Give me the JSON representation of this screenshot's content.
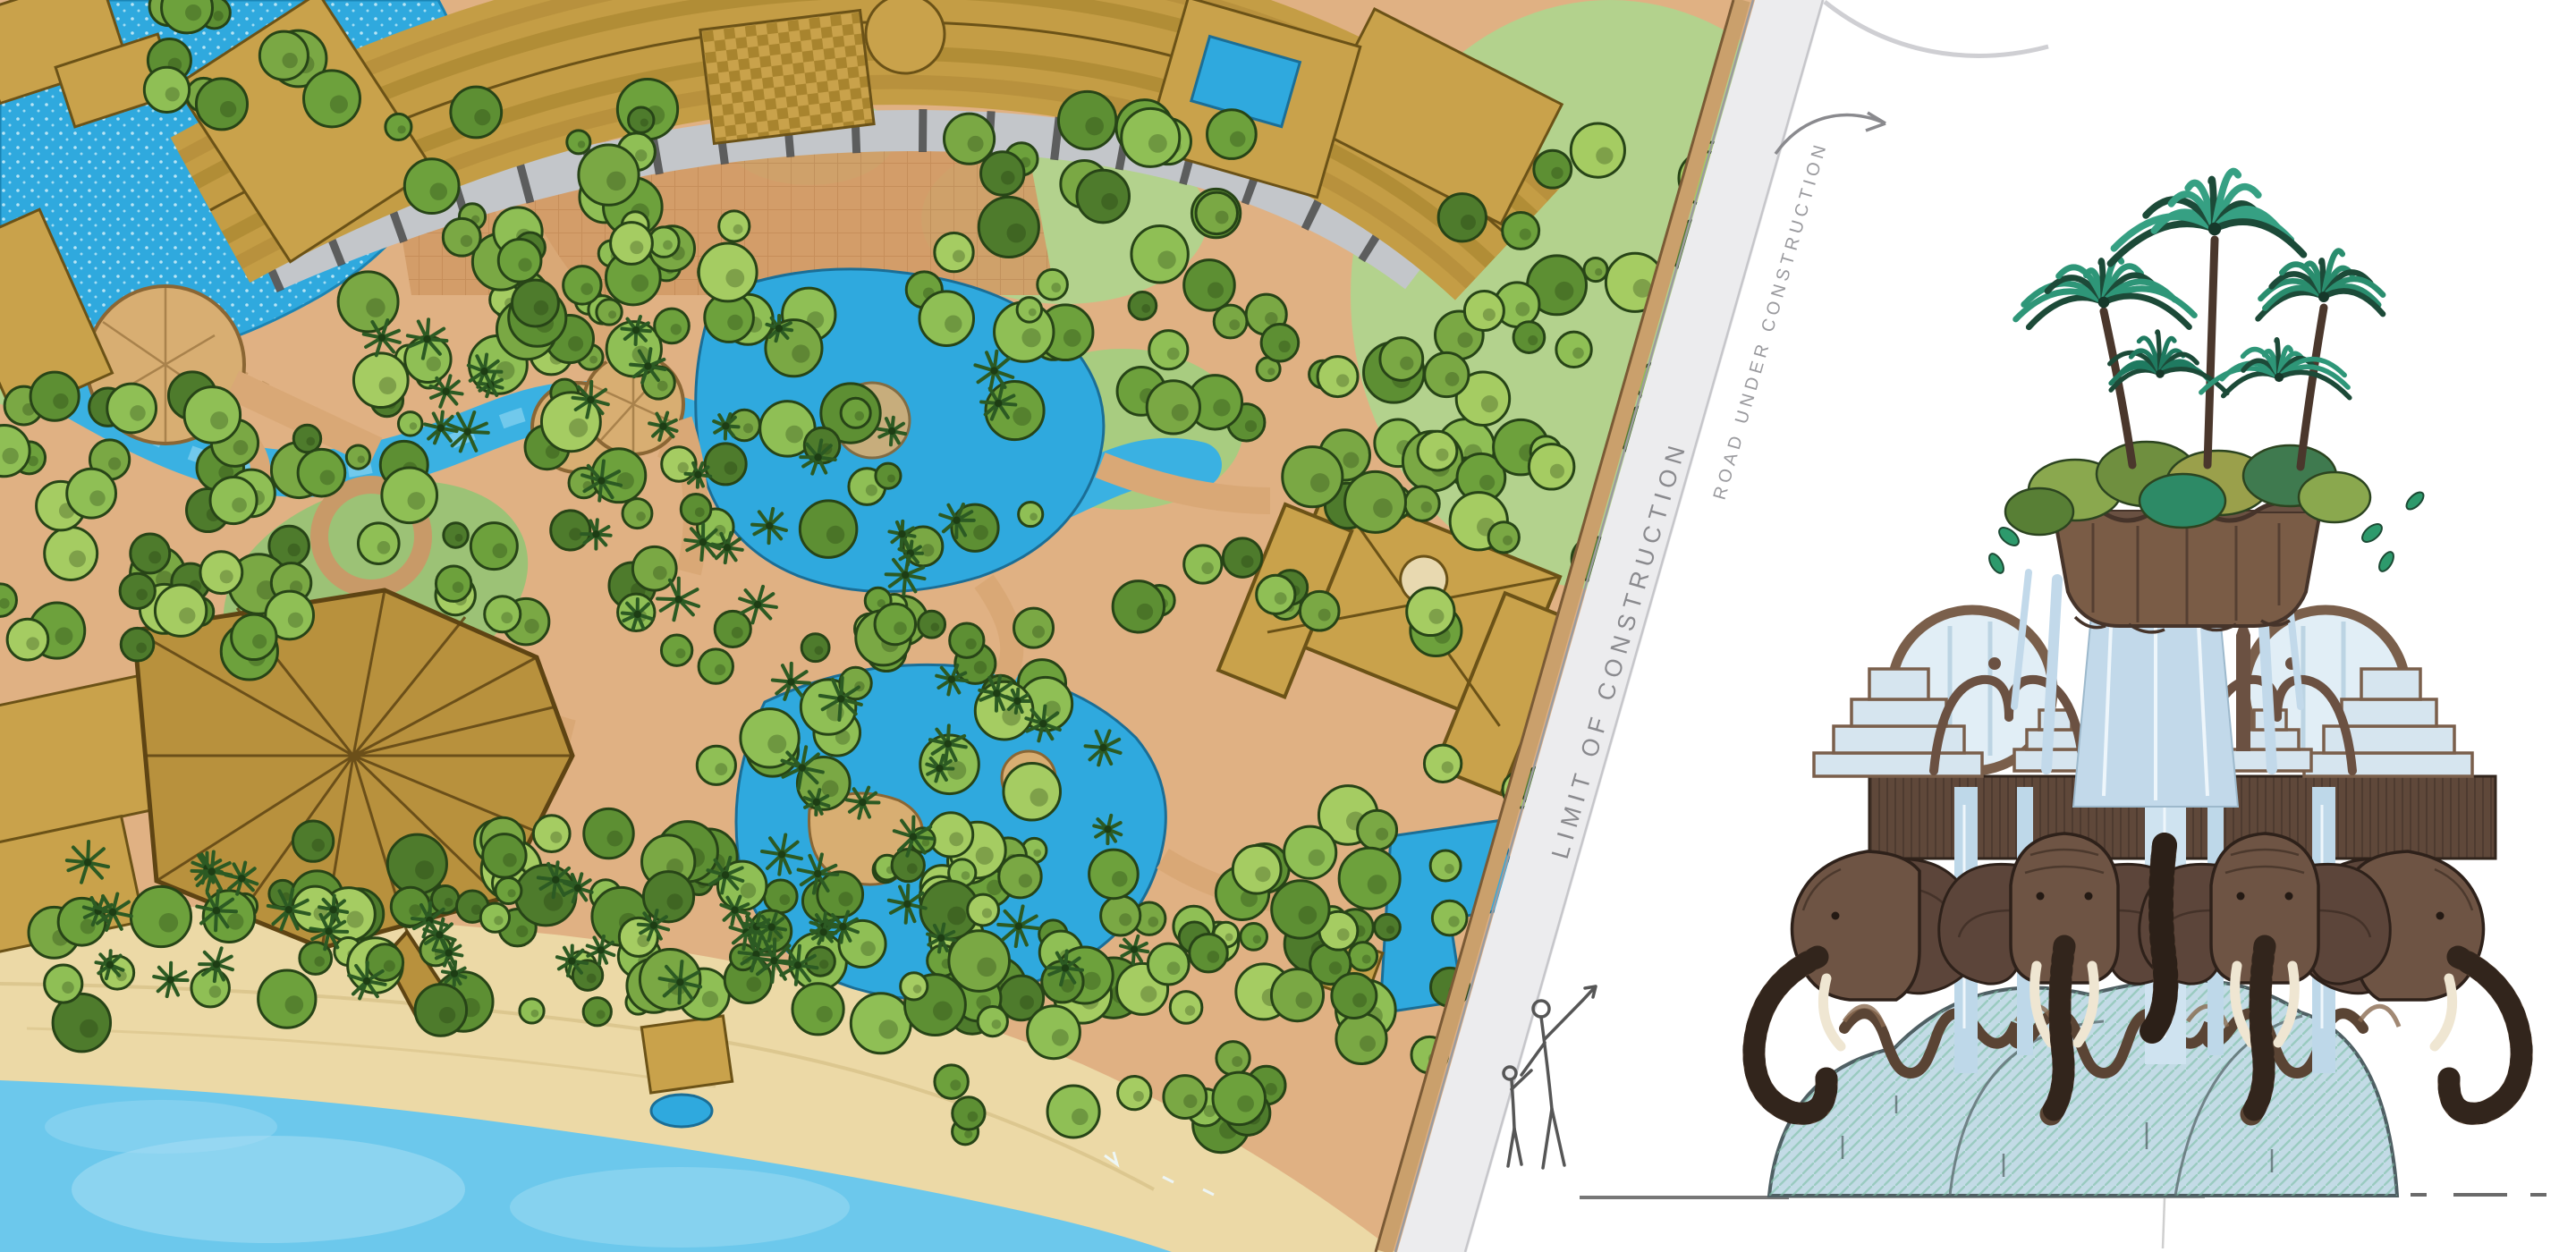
{
  "page": {
    "background": "#ffffff",
    "description": "Tropical resort water-park master plan beside a hand-drawn elephant waterfall fountain elevation sketch"
  },
  "site_plan": {
    "labels": {
      "limit_of_construction": "LIMIT OF CONSTRUCTION",
      "road_under_construction": "ROAD UNDER CONSTRUCTION"
    },
    "features": [
      "curved hotel wings with ribbed tan roofs",
      "wave pool with speckled water",
      "lazy river",
      "free-form lagoon pools",
      "island decks and round plazas",
      "angular lodge roof",
      "villa with courtyard pool",
      "beach",
      "ocean",
      "palm and shade tree canopy",
      "lawns",
      "construction road corridor"
    ],
    "colors": {
      "pool_blue": "#2fa9de",
      "river_blue": "#3ab1e2",
      "ocean_blue": "#6cc8ec",
      "sand": "#ecd9a6",
      "deck_terracotta": "#d29b66",
      "path_tan": "#d9a876",
      "roof_tan": "#c49d45",
      "roof_dark": "#a8842e",
      "lawn_green": "#b3d28d",
      "tree_green": "#7aa844",
      "road_gray": "#ececee"
    }
  },
  "fountain_sketch": {
    "elements": [
      "fan palm crown",
      "tropical foliage planter",
      "scalloped planter bowl",
      "cascading water curtains",
      "twin water hoops",
      "ogee brackets and spires",
      "stepped water tiers",
      "four carved elephant heads with white tusks",
      "curled trunks",
      "wavy skirt rim",
      "water-washed mound base",
      "ground line",
      "two human scale figures"
    ],
    "colors": {
      "palm_teal": "#2e9678",
      "foliage_olive": "#8aa84e",
      "carving_brown": "#6e5444",
      "carving_dark": "#3a2b22",
      "water_pale": "#c2d9ea",
      "tusk_ivory": "#efe6d2"
    }
  }
}
